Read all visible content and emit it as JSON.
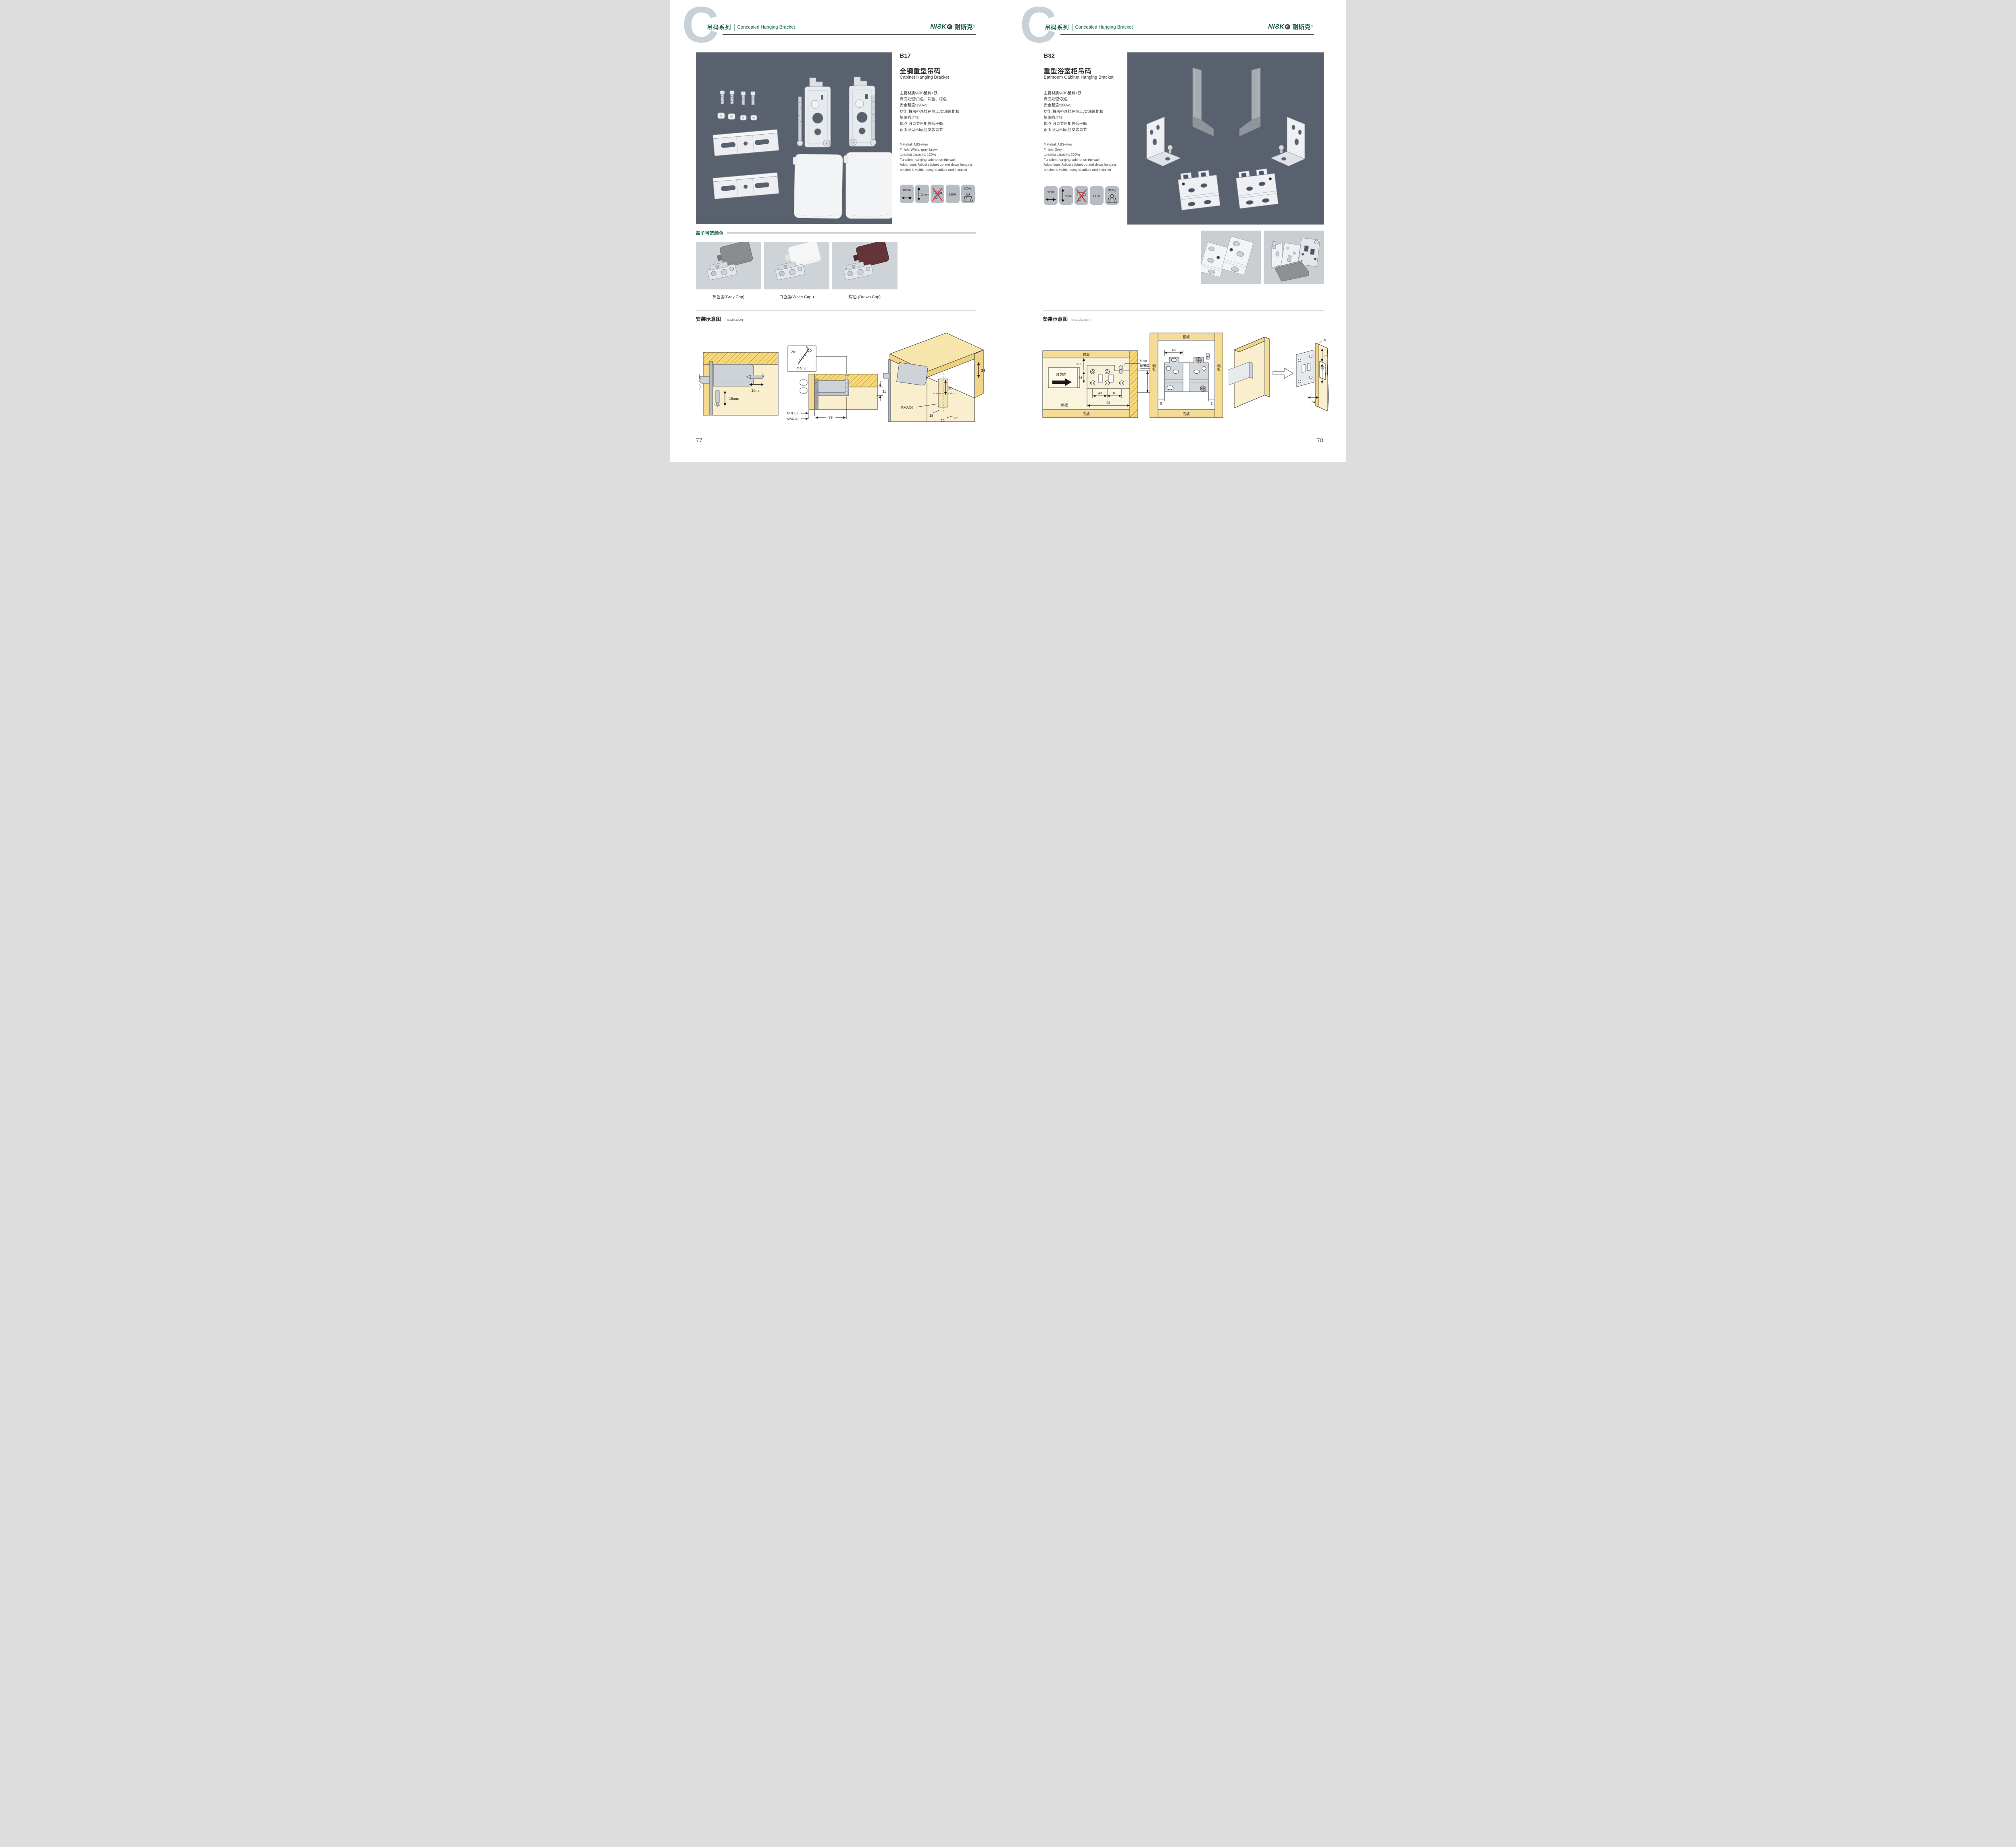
{
  "header": {
    "series_letter": "C",
    "series_zh": "吊码系列",
    "series_en": "Concealed Hanging Bracket",
    "brand_latin": "NIƧK",
    "brand_cn": "耐斯克",
    "brand_reg": "®"
  },
  "colors": {
    "accent_green": "#1a6b47",
    "brand_green": "#155c3e",
    "brand_red_dot": "#cc2128",
    "photo_bg": "#59616e",
    "icon_bg": "#b6bcc2",
    "wood_edge": "#f9d877",
    "wood_face": "#f9eecd",
    "cap_gray": "#8a8d90",
    "cap_white": "#f6f6f7",
    "cap_brown": "#643538"
  },
  "p77": {
    "page_no": "77",
    "code": "B17",
    "title_zh": "全钢重型吊码",
    "title_en": "Cabinet Hanging Bracket",
    "specs_zh": [
      "主要材质:ABS塑料+铁",
      "表面处理:白色、灰色、棕色",
      "安全载重:120kg",
      "功能:将吊柜悬挂在墙上,实现吊柜和",
      "墙体的连接",
      "优点:可调节吊柜高低平衡",
      "正面可见吊码,易安装调节"
    ],
    "specs_en": [
      "Material: ABS+iron",
      "Finish: White, gray, brown",
      "Loading capacity: 120kg",
      "Function: hanging cabinet on the wall",
      "Advantage: Adjust cabinet up and down hanging",
      "bracket is visible, easy to adjust and installed"
    ],
    "icons": [
      "10mm",
      "15mm",
      "",
      "LGA",
      "120Kg"
    ],
    "caps_title": "盖子可选颜色",
    "caps": [
      "灰色盖(Gray Cap)",
      "白色盖(White Cap )",
      "棕色 (Brown Cap)"
    ],
    "install_zh": "安装示意图",
    "install_en": "Installation",
    "d1": {
      "h": "10mm",
      "v": "15mm"
    },
    "d2": {
      "qty": "2x",
      "dia": "Φ4mm",
      "t": "13",
      "min": "MIN.10",
      "max": "MAX.30",
      "w": "78"
    },
    "d3": {
      "a": "34",
      "b": "32",
      "r": "RMAX4",
      "c": "18",
      "d": "20",
      "e": "32"
    }
  },
  "p78": {
    "page_no": "78",
    "code": "B32",
    "title_zh": "重型浴室柜吊码",
    "title_en": "Bathroom Cabinet Hanging Bracket",
    "specs_zh": [
      "主要材质:ABS塑料+铁",
      "表面处理:灰色",
      "安全载重:200kg",
      "功能:将吊柜悬挂在墙上,实现吊柜和",
      "墙体的连接",
      "优点:可调节吊柜高低平衡",
      "正面可见吊码,易安装调节"
    ],
    "specs_en": [
      "Material: ABS+iron",
      "Finish: Grey",
      "Loading capacity: 200kg",
      "Function: hanging cabinet on the wall",
      "Advantage: Adjust cabinet up and down hanging",
      "bracket is visible, easy to adjust and installed"
    ],
    "icons": [
      "4mm",
      "8mm",
      "",
      "LGA",
      "200Kg"
    ],
    "install_zh": "安装示意图",
    "install_en": "Installation",
    "d1": {
      "top": "顶板",
      "bottom": "底板",
      "side": "侧板",
      "cover": "装饰盖",
      "a": "36.5",
      "b": "36",
      "c": "40",
      "d": "40",
      "e": "98",
      "screw1": "8mm",
      "screw2": "调节螺丝",
      "f": "48"
    },
    "d2": {
      "top": "顶板",
      "bottom": "底板",
      "side_l": "侧板",
      "side_r": "侧板",
      "a": "48",
      "b": "80",
      "c": "5",
      "d": "5"
    },
    "d3": {
      "a": "18",
      "b": "35",
      "c": "47",
      "d": "24"
    }
  }
}
